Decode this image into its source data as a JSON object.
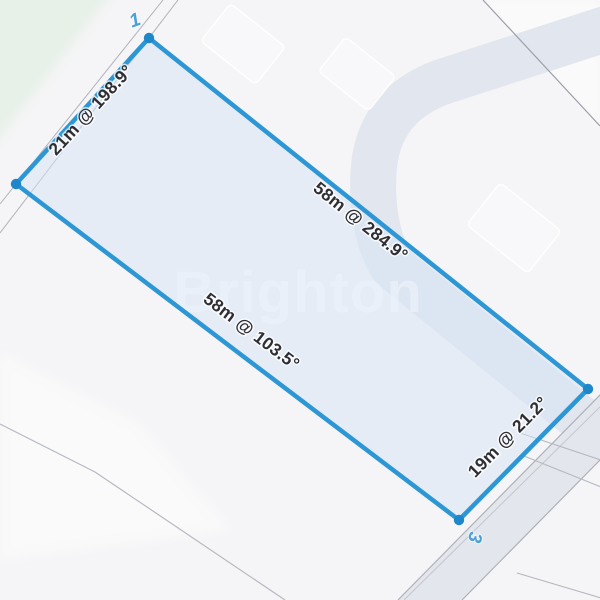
{
  "app": {
    "watermark": "Brighton"
  },
  "map": {
    "parcel": {
      "edges": [
        {
          "id": "west",
          "length_m": 21,
          "bearing_deg": 198.9,
          "label": "21m @ 198.9°"
        },
        {
          "id": "north",
          "length_m": 58,
          "bearing_deg": 284.9,
          "label": "58m @ 284.9°"
        },
        {
          "id": "south",
          "length_m": 58,
          "bearing_deg": 103.5,
          "label": "58m @ 103.5°"
        },
        {
          "id": "east",
          "length_m": 19,
          "bearing_deg": 21.2,
          "label": "19m @ 21.2°"
        }
      ],
      "vertex_count": 4
    },
    "lot_numbers": [
      {
        "label": "1"
      },
      {
        "label": "3"
      },
      {
        "label": "0"
      }
    ]
  },
  "colors": {
    "boundary_blue": "#2D97D5",
    "vertex_blue": "#1E87C9",
    "lot_number_blue": "#4AA0D8",
    "dimension_text": "#2E2E33",
    "parcel_fill": "rgba(214,228,246,0.5)",
    "background": "#F5F4F6",
    "green_area": "#E7F1E8",
    "utility_band": "#E2E6EE",
    "road_surface": "#E3E6EC",
    "boundary_line_grey": "#AEB1B8",
    "watermark_white": "rgba(255,255,255,0.75)"
  }
}
